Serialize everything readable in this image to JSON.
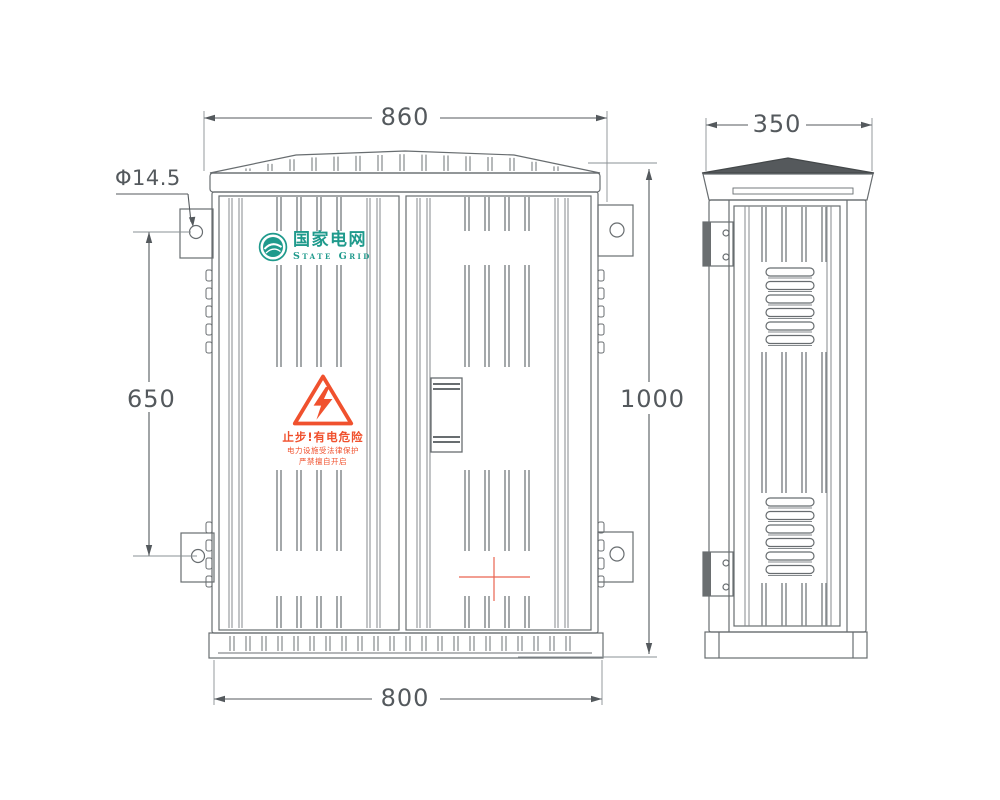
{
  "drawing": {
    "subject": "outdoor-distribution-cabinet",
    "views": [
      "front",
      "side"
    ]
  },
  "dimensions": {
    "roof_width": "860",
    "depth": "350",
    "base_width": "800",
    "height": "1000",
    "mount_hole_spacing": "650",
    "hole_diameter": "Φ14.5"
  },
  "logo": {
    "zh": "国家电网",
    "en": "State Grid"
  },
  "warning": {
    "line1": "止步!有电危险",
    "line2": "电力设施受法律保护",
    "line3": "严禁擅自开启"
  },
  "icons": {
    "emblem": "state-grid-emblem",
    "hazard": "warning-triangle-lightning",
    "center_mark": "red-crosshair"
  },
  "colors": {
    "line": "#686d70",
    "rib": "#858a8d",
    "dim": "#54595d",
    "logo_teal": "#1f9a8c",
    "warning_red": "#f0512e",
    "center_mark_red": "#e96450",
    "roof_dark": "#55595c"
  }
}
